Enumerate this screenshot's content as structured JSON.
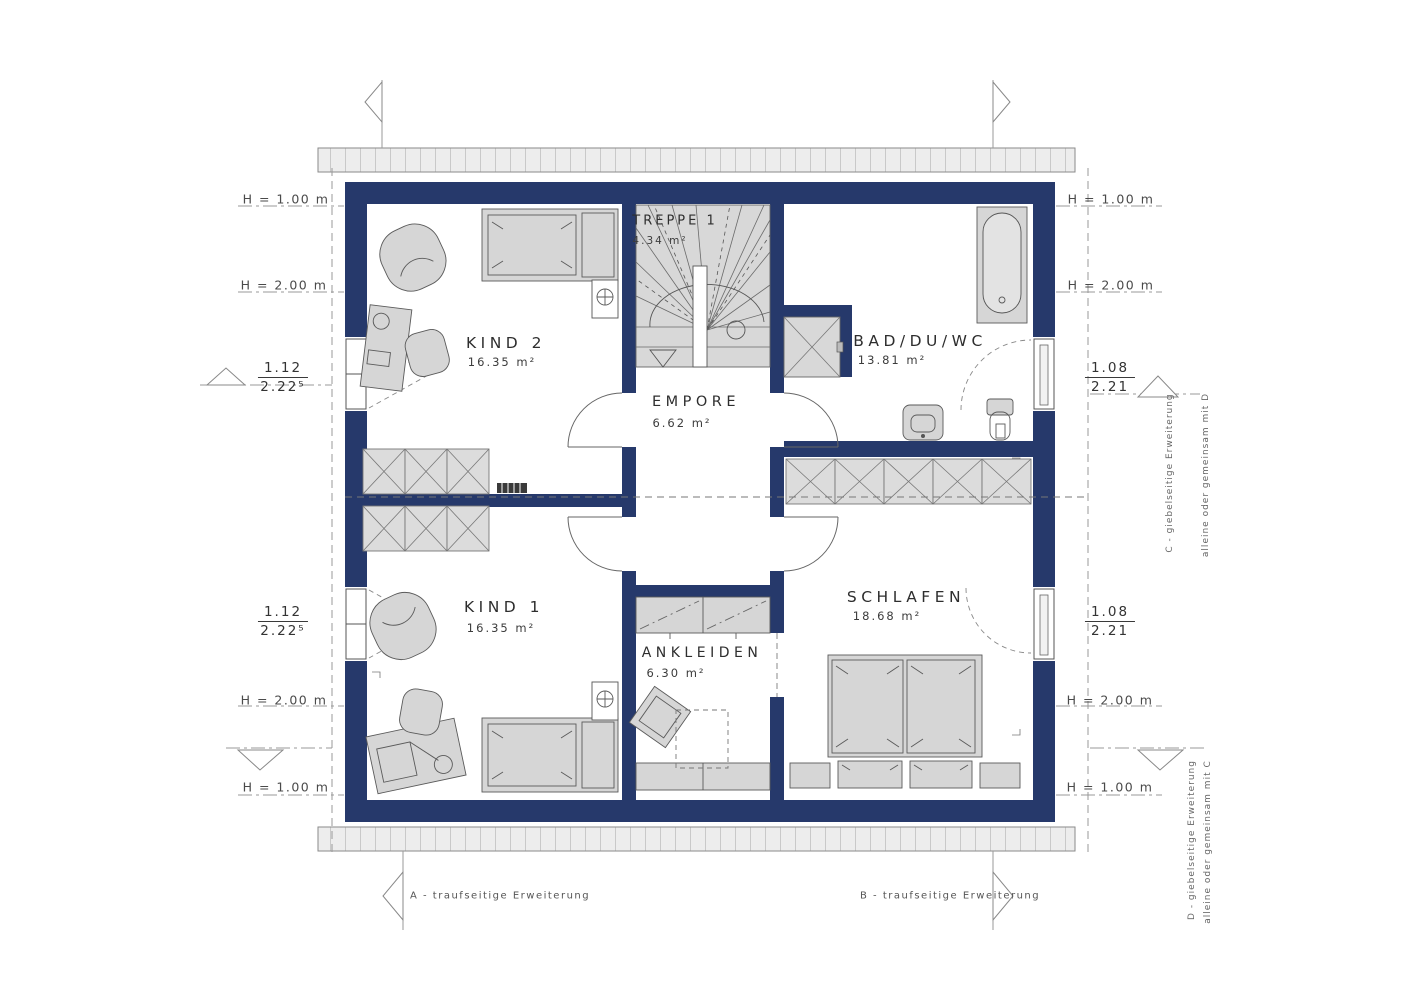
{
  "plan": {
    "rooms": [
      {
        "name": "KIND 2",
        "area": "16.35 m²"
      },
      {
        "name": "TREPPE 1",
        "area": "4.34 m²"
      },
      {
        "name": "EMPORE",
        "area": "6.62 m²"
      },
      {
        "name": "BAD/DU/WC",
        "area": "13.81 m²"
      },
      {
        "name": "KIND 1",
        "area": "16.35 m²"
      },
      {
        "name": "ANKLEIDEN",
        "area": "6.30 m²"
      },
      {
        "name": "SCHLAFEN",
        "area": "18.68 m²"
      }
    ]
  },
  "dimensions": {
    "left": {
      "h_top_1": "H = 1.00 m",
      "h_top_2": "H = 2.00 m",
      "window_top": {
        "num": "1.12",
        "den": "2.22⁵"
      },
      "window_bottom": {
        "num": "1.12",
        "den": "2.22⁵"
      },
      "h_bottom_2": "H = 2.00 m",
      "h_bottom_1": "H = 1.00 m"
    },
    "right": {
      "h_top_1": "H = 1.00 m",
      "h_top_2": "H = 2.00 m",
      "window_top": {
        "num": "1.08",
        "den": "2.21"
      },
      "window_bottom": {
        "num": "1.08",
        "den": "2.21"
      },
      "h_bottom_2": "H = 2.00 m",
      "h_bottom_1": "H = 1.00 m"
    }
  },
  "annotations": {
    "a": "A - traufseitige Erweiterung",
    "b": "B - traufseitige Erweiterung",
    "c_line1": "C - giebelseitige Erweiterung",
    "c_line2": "alleine oder gemeinsam mit D",
    "d_line1": "D - giebelseitige Erweiterung",
    "d_line2": "alleine oder gemeinsam mit C"
  },
  "colors": {
    "wall": "#26396b",
    "furniture": "#d6d6d6",
    "dash": "#888888"
  }
}
